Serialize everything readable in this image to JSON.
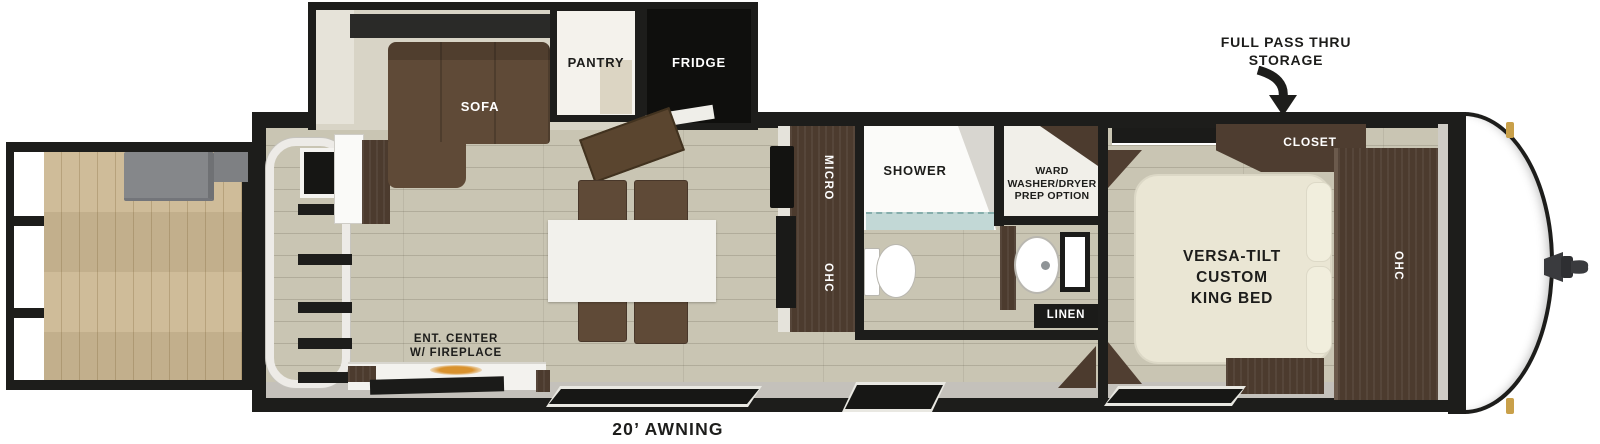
{
  "colors": {
    "outline": "#1d1d1b",
    "floor": "#c9c5b3",
    "deck_wood": "#ccb893",
    "beige_wall": "#d8d4c6",
    "dark_wood": "#4c3b2e",
    "sofa_brown": "#5f4a37",
    "bed_cream": "#eae6d4",
    "gray_band": "#c4c1bb",
    "bench_gray": "#85878a",
    "shower_tile": "#c2d8d6",
    "fire_glow": "#d9922e",
    "marker_gold": "#c9a04a",
    "hitch_gray": "#3a3b3e"
  },
  "labels": {
    "storage_callout": "FULL PASS THRU\nSTORAGE",
    "sofa": "SOFA",
    "pantry": "PANTRY",
    "fridge": "FRIDGE",
    "micro": "MICRO",
    "kitchen_ohc": "OHC",
    "shower": "SHOWER",
    "ward": "WARD\nWASHER/DRYER\nPREP OPTION",
    "linen": "LINEN",
    "closet": "CLOSET",
    "bedroom_ohc": "OHC",
    "king_bed": "VERSA-TILT\nCUSTOM\nKING BED",
    "ent_center": "ENT. CENTER\nW/ FIREPLACE",
    "awning": "20’ AWNING"
  }
}
